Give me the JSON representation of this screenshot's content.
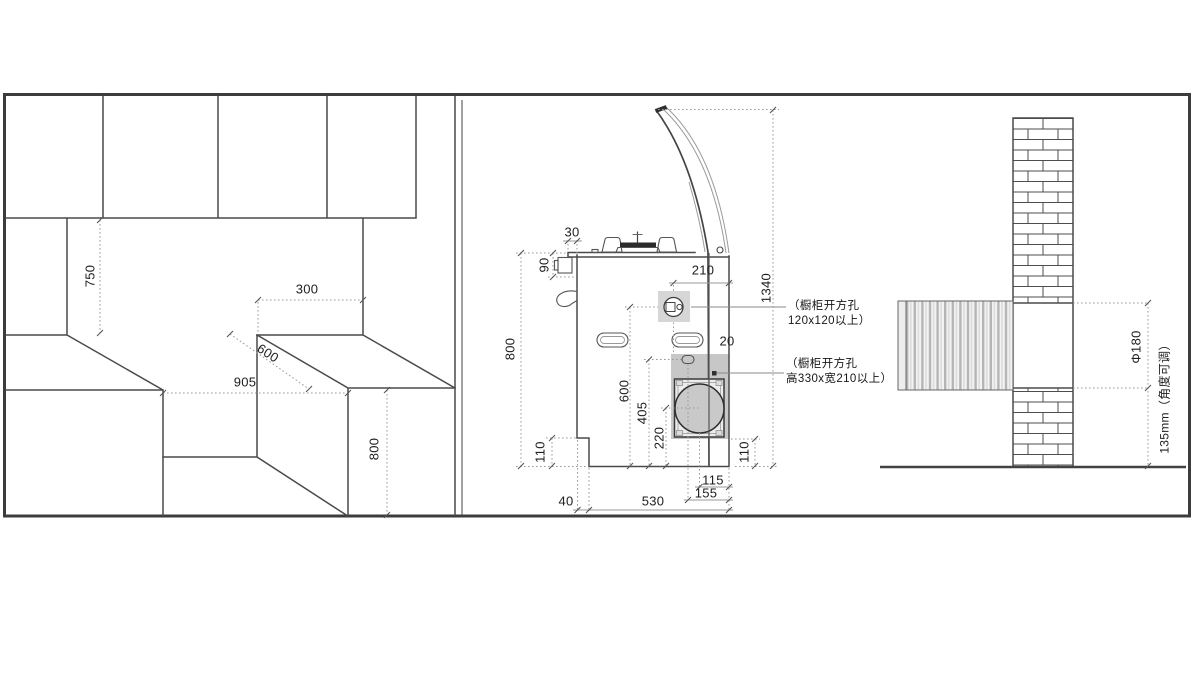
{
  "figure": {
    "title_semantic": "integrated-stove-installation-diagram",
    "left_view": {
      "d750": "750",
      "d300": "300",
      "d600": "600",
      "d905": "905",
      "d800": "800"
    },
    "middle_view": {
      "d30": "30",
      "d90": "90",
      "d800": "800",
      "d110_left": "110",
      "d1340": "1340",
      "d210": "210",
      "d20": "20",
      "d600": "600",
      "d405": "405",
      "d220": "220",
      "d110_right": "110",
      "d115": "115",
      "d155": "155",
      "d530": "530",
      "d40": "40",
      "ann_gas_line1": "（橱柜开方孔",
      "ann_gas_line2": "120x120以上）",
      "ann_duct_line1": "（橱柜开方孔",
      "ann_duct_line2": "高330x宽210以上）"
    },
    "right_view": {
      "d_diameter": "Φ180",
      "d_offset": "135mm（角度可调）"
    }
  }
}
